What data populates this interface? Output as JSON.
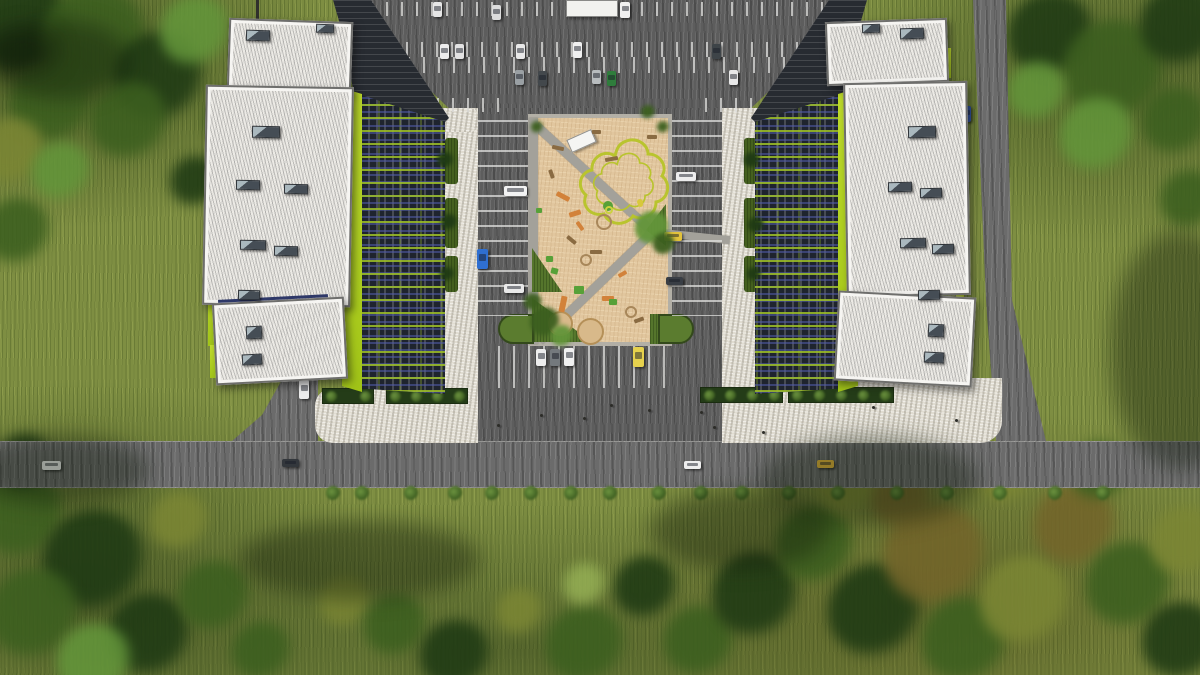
{
  "scene": {
    "title": "Aerial architectural rendering",
    "description": "Top-down aerial render of two mid-rise buildings with dark glass facades and lime-green accents flanking a tan central playground plaza, surrounded by parking lots, a stone esplanade, access roads, lawns and trees"
  },
  "palette": {
    "grass": "#7e8e42",
    "asphalt": "#5d5d5d",
    "road": "#6b6b6b",
    "stone": "#e0dcd1",
    "plaza_tan": "#e1c69e",
    "roof_white": "#eceae5",
    "lime_accent": "#b5d916",
    "facade_glass": "#1f242e",
    "path_gray": "#a3a19a",
    "hedge_green": "#3c5c20",
    "sand": "#d8b98a",
    "taxi_yellow": "#e7b93c"
  },
  "tree_colors": {
    "dark": "#1f3a14",
    "mid": "#3c5f1f",
    "bright": "#63953a",
    "olive": "#7b8634",
    "brown": "#73652a",
    "lite": "#93ad53"
  },
  "trees_background": [
    [
      25,
      28,
      48,
      "dark"
    ],
    [
      95,
      42,
      55,
      "mid"
    ],
    [
      160,
      78,
      46,
      "dark"
    ],
    [
      52,
      104,
      42,
      "mid"
    ],
    [
      196,
      32,
      36,
      "bright"
    ],
    [
      130,
      122,
      40,
      "mid"
    ],
    [
      12,
      152,
      34,
      "olive"
    ],
    [
      62,
      172,
      30,
      "bright"
    ],
    [
      18,
      232,
      34,
      "mid"
    ],
    [
      196,
      182,
      26,
      "dark"
    ],
    [
      230,
      120,
      24,
      "mid"
    ],
    [
      1052,
      36,
      44,
      "dark"
    ],
    [
      1115,
      72,
      52,
      "mid"
    ],
    [
      1182,
      26,
      42,
      "dark"
    ],
    [
      1098,
      136,
      38,
      "bright"
    ],
    [
      1176,
      122,
      34,
      "mid"
    ],
    [
      1038,
      92,
      30,
      "bright"
    ],
    [
      1190,
      200,
      30,
      "mid"
    ],
    [
      22,
      516,
      44,
      "mid"
    ],
    [
      95,
      562,
      52,
      "dark"
    ],
    [
      35,
      615,
      46,
      "mid"
    ],
    [
      150,
      636,
      42,
      "dark"
    ],
    [
      215,
      597,
      36,
      "mid"
    ],
    [
      95,
      662,
      38,
      "bright"
    ],
    [
      180,
      522,
      30,
      "olive"
    ],
    [
      262,
      652,
      30,
      "mid"
    ],
    [
      25,
      462,
      28,
      "dark"
    ],
    [
      345,
      602,
      26,
      "olive"
    ],
    [
      396,
      626,
      32,
      "mid"
    ],
    [
      456,
      656,
      36,
      "dark"
    ],
    [
      520,
      612,
      24,
      "olive"
    ],
    [
      586,
      646,
      40,
      "mid"
    ],
    [
      646,
      588,
      32,
      "dark"
    ],
    [
      700,
      642,
      36,
      "mid"
    ],
    [
      585,
      585,
      22,
      "lite"
    ],
    [
      756,
      596,
      44,
      "dark"
    ],
    [
      816,
      546,
      40,
      "mid"
    ],
    [
      876,
      612,
      48,
      "dark"
    ],
    [
      850,
      482,
      34,
      "olive"
    ],
    [
      936,
      556,
      52,
      "brown"
    ],
    [
      966,
      642,
      44,
      "mid"
    ],
    [
      1026,
      602,
      46,
      "olive"
    ],
    [
      1076,
      526,
      42,
      "brown"
    ],
    [
      1130,
      586,
      44,
      "mid"
    ],
    [
      1186,
      542,
      36,
      "olive"
    ],
    [
      1182,
      642,
      40,
      "dark"
    ],
    [
      1006,
      472,
      32,
      "olive"
    ],
    [
      1100,
      472,
      30,
      "mid"
    ],
    [
      902,
      500,
      30,
      "brown"
    ]
  ],
  "trees_detail": [
    [
      652,
      228,
      17,
      "bright"
    ],
    [
      664,
      244,
      11,
      "mid"
    ],
    [
      545,
      322,
      15,
      "mid"
    ],
    [
      562,
      336,
      11,
      "bright"
    ],
    [
      533,
      302,
      9,
      "mid"
    ],
    [
      537,
      127,
      6,
      "mid"
    ],
    [
      663,
      127,
      6,
      "mid"
    ],
    [
      648,
      112,
      7,
      "mid"
    ],
    [
      445,
      160,
      8,
      "dark"
    ],
    [
      449,
      222,
      8,
      "dark"
    ],
    [
      447,
      274,
      7,
      "dark"
    ],
    [
      752,
      160,
      8,
      "dark"
    ],
    [
      756,
      225,
      8,
      "dark"
    ],
    [
      754,
      274,
      7,
      "dark"
    ]
  ],
  "bush_row": {
    "y": 493,
    "r": 7,
    "xs": [
      333,
      362,
      411,
      455,
      492,
      531,
      571,
      610,
      659,
      701,
      742,
      789,
      838,
      897,
      947,
      1000,
      1055,
      1103
    ]
  },
  "grass_pockets": [
    [
      445,
      138,
      13,
      46
    ],
    [
      445,
      198,
      13,
      50
    ],
    [
      445,
      256,
      13,
      36
    ],
    [
      744,
      138,
      13,
      46
    ],
    [
      744,
      198,
      13,
      50
    ],
    [
      744,
      256,
      13,
      36
    ]
  ],
  "planters": [
    [
      322,
      388,
      52,
      16
    ],
    [
      386,
      388,
      82,
      16
    ],
    [
      700,
      387,
      83,
      16
    ],
    [
      788,
      387,
      106,
      16
    ]
  ],
  "stall_rows": [
    [
      356,
      2,
      490,
      14,
      "v"
    ],
    [
      376,
      42,
      465,
      15,
      "v"
    ],
    [
      378,
      57,
      462,
      16,
      "v"
    ],
    [
      392,
      98,
      120,
      14,
      "v"
    ],
    [
      705,
      98,
      135,
      14,
      "v"
    ],
    [
      478,
      120,
      50,
      196,
      "h"
    ],
    [
      672,
      120,
      50,
      196,
      "h"
    ],
    [
      498,
      346,
      172,
      42,
      "v"
    ]
  ],
  "cars": [
    [
      433,
      2,
      9,
      15,
      "#e6e6e6"
    ],
    [
      492,
      5,
      9,
      15,
      "#dcdcdc"
    ],
    [
      620,
      2,
      10,
      16,
      "#f0f0f0"
    ],
    [
      440,
      44,
      9,
      15,
      "#ececec"
    ],
    [
      455,
      44,
      9,
      15,
      "#e2e2e2"
    ],
    [
      516,
      44,
      9,
      15,
      "#e8e8e8"
    ],
    [
      573,
      42,
      9,
      16,
      "#f0f0f0"
    ],
    [
      712,
      44,
      9,
      15,
      "#3e4448"
    ],
    [
      515,
      70,
      9,
      15,
      "#9aa0a4"
    ],
    [
      538,
      71,
      9,
      15,
      "#43484c"
    ],
    [
      592,
      70,
      9,
      14,
      "#b8bcbe"
    ],
    [
      607,
      71,
      9,
      15,
      "#2f7d3c"
    ],
    [
      729,
      70,
      9,
      15,
      "#e8e8e8"
    ],
    [
      504,
      186,
      23,
      10,
      "#f2f2f2"
    ],
    [
      477,
      249,
      11,
      20,
      "#2f6fd0"
    ],
    [
      504,
      284,
      20,
      9,
      "#e9e9e9"
    ],
    [
      676,
      172,
      20,
      9,
      "#ededed"
    ],
    [
      664,
      232,
      18,
      9,
      "#e2c23b"
    ],
    [
      666,
      277,
      17,
      8,
      "#393e45"
    ],
    [
      536,
      349,
      10,
      17,
      "#ededed"
    ],
    [
      550,
      349,
      10,
      17,
      "#74797d"
    ],
    [
      564,
      348,
      10,
      18,
      "#f0f0f0"
    ],
    [
      633,
      347,
      11,
      20,
      "#e6d14d"
    ],
    [
      42,
      461,
      19,
      9,
      "#f0f0f0"
    ],
    [
      282,
      459,
      17,
      8,
      "#33373c"
    ],
    [
      684,
      461,
      17,
      8,
      "#eeeeee"
    ],
    [
      817,
      460,
      17,
      8,
      "#e7b93c"
    ],
    [
      962,
      106,
      9,
      16,
      "#2e4f9e"
    ],
    [
      299,
      380,
      10,
      19,
      "#ececec"
    ]
  ],
  "people": [
    [
      497,
      424
    ],
    [
      540,
      414
    ],
    [
      583,
      417
    ],
    [
      648,
      409
    ],
    [
      713,
      426
    ],
    [
      762,
      431
    ],
    [
      872,
      406
    ],
    [
      955,
      419
    ],
    [
      700,
      411
    ],
    [
      610,
      404
    ]
  ],
  "playground_items": [
    [
      552,
      146,
      12,
      4,
      12,
      "#8a6b42",
      "rect"
    ],
    [
      592,
      130,
      9,
      4,
      0,
      "#8a6b42",
      "rect"
    ],
    [
      605,
      157,
      13,
      4,
      -10,
      "#8a6b42",
      "rect"
    ],
    [
      647,
      135,
      10,
      4,
      0,
      "#8a6b42",
      "rect"
    ],
    [
      566,
      238,
      11,
      4,
      40,
      "#8a6b42",
      "rect"
    ],
    [
      590,
      250,
      12,
      4,
      0,
      "#8a6b42",
      "rect"
    ],
    [
      634,
      318,
      10,
      4,
      -20,
      "#8a6b42",
      "rect"
    ],
    [
      547,
      172,
      9,
      4,
      70,
      "#8a6b42",
      "rect"
    ],
    [
      556,
      194,
      14,
      5,
      28,
      "#d2823a",
      "rect"
    ],
    [
      569,
      211,
      12,
      5,
      -18,
      "#d2823a",
      "rect"
    ],
    [
      575,
      224,
      10,
      4,
      55,
      "#d2823a",
      "rect"
    ],
    [
      560,
      296,
      6,
      16,
      12,
      "#d2823a",
      "rect"
    ],
    [
      602,
      296,
      12,
      5,
      0,
      "#d2823a",
      "rect"
    ],
    [
      618,
      272,
      9,
      4,
      -30,
      "#d2823a",
      "rect"
    ],
    [
      546,
      256,
      7,
      6,
      0,
      "#57a138",
      "rect"
    ],
    [
      551,
      268,
      7,
      6,
      15,
      "#57a138",
      "rect"
    ],
    [
      574,
      286,
      10,
      8,
      0,
      "#57a138",
      "rect"
    ],
    [
      609,
      299,
      8,
      6,
      0,
      "#57a138",
      "rect"
    ],
    [
      536,
      208,
      6,
      5,
      0,
      "#57a138",
      "rect"
    ],
    [
      596,
      214,
      16,
      16,
      0,
      "#a8875a",
      "ring"
    ],
    [
      580,
      254,
      12,
      12,
      0,
      "#a8875a",
      "ring"
    ],
    [
      625,
      306,
      12,
      12,
      0,
      "#a8875a",
      "ring"
    ],
    [
      605,
      206,
      8,
      8,
      0,
      "#cbd23e",
      "ring"
    ],
    [
      638,
      202,
      5,
      5,
      0,
      "#d8c83c",
      "circle"
    ]
  ],
  "roof_units": [
    [
      246,
      30,
      24,
      11,
      2
    ],
    [
      316,
      24,
      18,
      9,
      2
    ],
    [
      252,
      126,
      28,
      12,
      1
    ],
    [
      236,
      180,
      24,
      10,
      1
    ],
    [
      284,
      184,
      24,
      10,
      1
    ],
    [
      240,
      240,
      26,
      10,
      1
    ],
    [
      274,
      246,
      24,
      10,
      1
    ],
    [
      238,
      290,
      22,
      10,
      1
    ],
    [
      246,
      326,
      16,
      13,
      -3
    ],
    [
      242,
      354,
      20,
      11,
      -3
    ],
    [
      900,
      28,
      24,
      11,
      -2
    ],
    [
      862,
      24,
      18,
      9,
      -2
    ],
    [
      908,
      126,
      28,
      12,
      -1
    ],
    [
      888,
      182,
      24,
      10,
      -1
    ],
    [
      920,
      188,
      22,
      10,
      -1
    ],
    [
      900,
      238,
      26,
      10,
      -1
    ],
    [
      932,
      244,
      22,
      10,
      -1
    ],
    [
      918,
      290,
      22,
      10,
      -1
    ],
    [
      928,
      324,
      16,
      13,
      3
    ],
    [
      924,
      352,
      20,
      11,
      3
    ]
  ],
  "lime_strips": [
    [
      206,
      93,
      7,
      46
    ],
    [
      208,
      268,
      7,
      78
    ],
    [
      210,
      345,
      6,
      33
    ],
    [
      956,
      295,
      8,
      56
    ],
    [
      944,
      48,
      7,
      30
    ]
  ],
  "shadow_blobs": [
    [
      60,
      60,
      70,
      40
    ],
    [
      870,
      480,
      110,
      45
    ],
    [
      740,
      530,
      90,
      40
    ],
    [
      60,
      470,
      90,
      35
    ],
    [
      360,
      560,
      120,
      40
    ],
    [
      1180,
      350,
      70,
      120
    ],
    [
      20,
      52,
      40,
      25
    ]
  ]
}
